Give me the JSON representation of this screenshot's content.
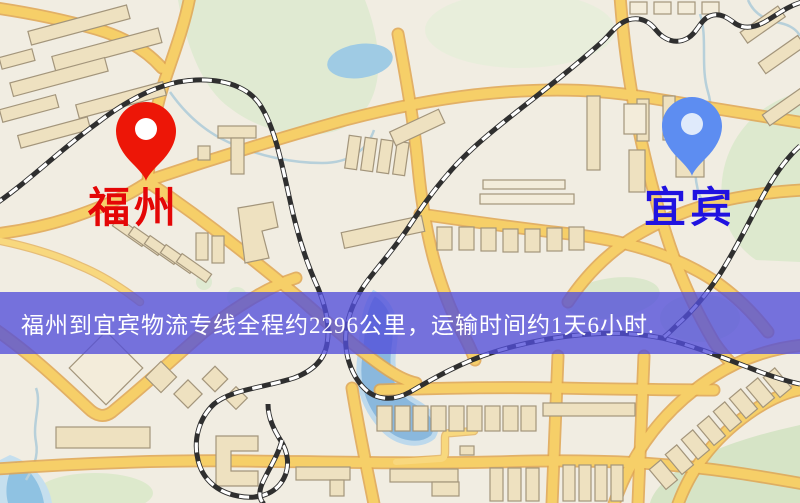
{
  "map": {
    "type": "road-map",
    "origin_marker": {
      "label": "福州",
      "pin_color": "#ed1607",
      "pin_dot_color": "#ffffff",
      "label_color": "#e40606"
    },
    "destination_marker": {
      "label": "宜宾",
      "pin_color": "#5d8df1",
      "pin_dot_color": "#dfeafb",
      "label_color": "#2012e0"
    },
    "banner": {
      "text": "福州到宜宾物流专线全程约2296公里，运输时间约1天6小时.",
      "background_rgba": "rgba(82,78,218,0.78)",
      "text_color": "#ffffff"
    },
    "palette": {
      "land": "#f1ede2",
      "road_fill": "#f6cf68",
      "road_casing": "#dfa550",
      "park": "#dde9ce",
      "water": "#8ab8dd",
      "pond": "#9fcbe4",
      "railway_dark": "#2f2f2f",
      "railway_light": "#ffffff",
      "building_fill": "#eee1c0",
      "building_stroke": "#a3957b"
    }
  }
}
